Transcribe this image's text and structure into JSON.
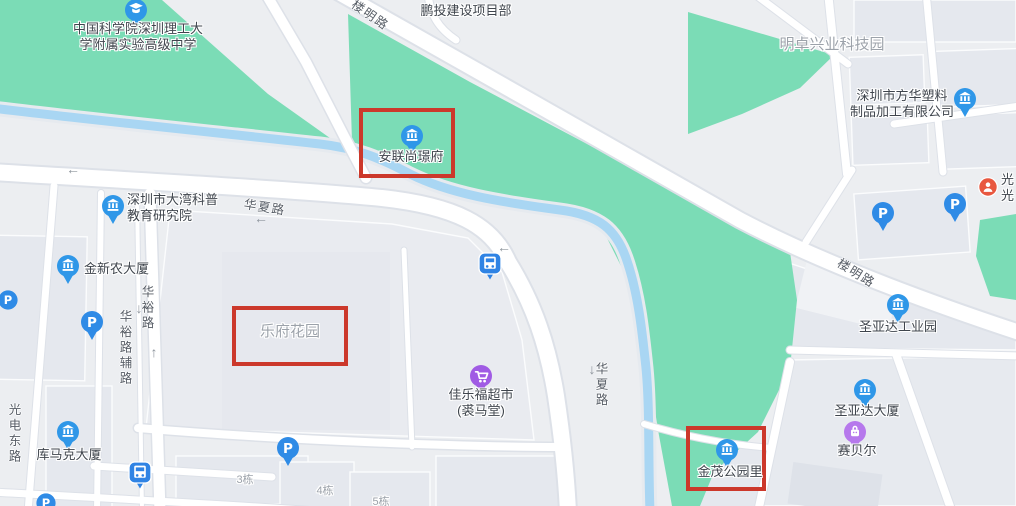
{
  "canvas": {
    "width": 1016,
    "height": 506
  },
  "colors": {
    "base_gray": "#ECEEF1",
    "block_gray": "#E5E8EE",
    "green": "#7BDCB6",
    "water_blue": "#A9D6F3",
    "road_white": "#FFFFFF",
    "highlight_red": "#CC382B",
    "pin_blue": "#2F97E8",
    "bus_blue": "#2F83E4",
    "cart_purple": "#A05BE4",
    "bag_purple": "#B678EC",
    "alert_red": "#E8573F",
    "poi_text": "#3F454D",
    "road_text": "#575D66",
    "area_text": "#9CA2AA"
  },
  "red_boxes": [
    {
      "name": "highlight-anlian-shangjingfu",
      "x": 359,
      "y": 108,
      "w": 96,
      "h": 70
    },
    {
      "name": "highlight-lefu-huayuan",
      "x": 232,
      "y": 306,
      "w": 116,
      "h": 60
    },
    {
      "name": "highlight-jinmao-gongyuanli",
      "x": 686,
      "y": 426,
      "w": 80,
      "h": 65
    }
  ],
  "pois": [
    {
      "name": "school-shenzhen-ligong",
      "icon": "pin-school",
      "ix": 136,
      "iy": 10,
      "lines": [
        "中国科学院深圳理工大",
        "学附属实验高级中学"
      ],
      "lx": 138,
      "ly": 37,
      "align": "center"
    },
    {
      "name": "pengtou-project",
      "icon": "none",
      "lines": [
        "鹏投建设项目部"
      ],
      "lx": 466,
      "ly": 11,
      "align": "center"
    },
    {
      "name": "fanghua-plastics",
      "icon": "pin-building",
      "ix": 965,
      "iy": 99,
      "lines": [
        "深圳市方华塑料",
        "制品加工有限公司"
      ],
      "lx": 902,
      "ly": 104,
      "align": "center"
    },
    {
      "name": "anlian-shangjingfu",
      "icon": "pin-building",
      "ix": 412,
      "iy": 136,
      "lines": [
        "安联尚璟府"
      ],
      "lx": 411,
      "ly": 157,
      "align": "center"
    },
    {
      "name": "dawan-kepu-institute",
      "icon": "pin-building",
      "ix": 113,
      "iy": 206,
      "lines": [
        "深圳市大湾科普",
        "教育研究院"
      ],
      "lx": 127,
      "ly": 208,
      "align": "left"
    },
    {
      "name": "jinxinnong-tower",
      "icon": "pin-building",
      "ix": 68,
      "iy": 266,
      "lines": [
        "金新农大厦"
      ],
      "lx": 84,
      "ly": 269,
      "align": "left"
    },
    {
      "name": "jialefu-supermarket",
      "icon": "pin-cart",
      "ix": 481,
      "iy": 376,
      "lines": [
        "佳乐福超市",
        "(裘马堂)"
      ],
      "lx": 481,
      "ly": 403,
      "align": "center"
    },
    {
      "name": "shengyada-industrial-park",
      "icon": "pin-building",
      "ix": 898,
      "iy": 305,
      "lines": [
        "圣亚达工业园"
      ],
      "lx": 898,
      "ly": 327,
      "align": "center"
    },
    {
      "name": "shengyada-tower",
      "icon": "pin-building",
      "ix": 865,
      "iy": 390,
      "lines": [
        "圣亚达大厦"
      ],
      "lx": 867,
      "ly": 411,
      "align": "center"
    },
    {
      "name": "saibeier",
      "icon": "pin-bag",
      "ix": 855,
      "iy": 432,
      "lines": [
        "赛贝尔"
      ],
      "lx": 857,
      "ly": 451,
      "align": "center"
    },
    {
      "name": "jinmao-gongyuanli",
      "icon": "pin-building",
      "ix": 727,
      "iy": 450,
      "lines": [
        "金茂公园里"
      ],
      "lx": 730,
      "ly": 472,
      "align": "center"
    },
    {
      "name": "kumake-tower",
      "icon": "pin-building",
      "ix": 68,
      "iy": 432,
      "lines": [
        "库马克大厦"
      ],
      "lx": 69,
      "ly": 455,
      "align": "center"
    },
    {
      "name": "guang-clipped",
      "icon": "circle-alert",
      "ix": 988,
      "iy": 187,
      "lines": [
        "光",
        "光"
      ],
      "lx": 1001,
      "ly": 188,
      "align": "left"
    },
    {
      "name": "parking-huayu",
      "icon": "pin-p",
      "ix": 92,
      "iy": 322
    },
    {
      "name": "parking-grid-west",
      "icon": "pin-p",
      "ix": 883,
      "iy": 213
    },
    {
      "name": "parking-grid-east",
      "icon": "pin-p",
      "ix": 955,
      "iy": 204
    },
    {
      "name": "parking-left-edge",
      "icon": "circle-p",
      "ix": 8,
      "iy": 300
    },
    {
      "name": "parking-lefu-south",
      "icon": "pin-p",
      "ix": 288,
      "iy": 448
    },
    {
      "name": "parking-bottom-left",
      "icon": "circle-p",
      "ix": 46,
      "iy": 503
    },
    {
      "name": "bus-stop-huaxia",
      "icon": "bus",
      "ix": 490,
      "iy": 263
    },
    {
      "name": "bus-stop-south",
      "icon": "bus",
      "ix": 140,
      "iy": 472
    }
  ],
  "area_labels": [
    {
      "name": "mingzhuo-tech-park",
      "text": "明卓兴业科技园",
      "x": 832,
      "y": 45,
      "size": 15
    },
    {
      "name": "lefu-huayuan",
      "text": "乐府花园",
      "x": 290,
      "y": 332,
      "size": 15
    },
    {
      "name": "building-3",
      "text": "3栋",
      "x": 245,
      "y": 480,
      "size": 11
    },
    {
      "name": "building-4",
      "text": "4栋",
      "x": 325,
      "y": 491,
      "size": 11
    },
    {
      "name": "building-5",
      "text": "5栋",
      "x": 381,
      "y": 502,
      "size": 11
    }
  ],
  "road_labels": [
    {
      "name": "louming-road-nw",
      "text": "楼明路",
      "x": 371,
      "y": 14,
      "rot": 35
    },
    {
      "name": "louming-road-se",
      "text": "楼明路",
      "x": 857,
      "y": 272,
      "rot": 32
    },
    {
      "name": "huaxia-road-h",
      "text": "华夏路",
      "x": 265,
      "y": 206,
      "rot": 9
    },
    {
      "name": "huaxia-road-v",
      "text": "华夏路",
      "x": 601,
      "y": 385,
      "vertical": true
    },
    {
      "name": "huayu-road",
      "text": "华裕路",
      "x": 147,
      "y": 308,
      "vertical": true
    },
    {
      "name": "huayu-frontage-road",
      "text": "华裕路辅路",
      "x": 125,
      "y": 348,
      "vertical": true
    },
    {
      "name": "guangdian-east-road",
      "text": "光电东路",
      "x": 14,
      "y": 434,
      "vertical": true
    }
  ],
  "arrows": [
    {
      "name": "arrow-left-huaxia-w",
      "glyph": "←",
      "x": 73,
      "y": 169
    },
    {
      "name": "arrow-left-huaxia-label",
      "glyph": "←",
      "x": 261,
      "y": 218
    },
    {
      "name": "arrow-left-huaxia-corner",
      "glyph": "←",
      "x": 504,
      "y": 247
    },
    {
      "name": "arrow-up-huayu",
      "glyph": "↑",
      "x": 154,
      "y": 352
    },
    {
      "name": "arrow-down-huayu-label",
      "glyph": "↓",
      "x": 139,
      "y": 308
    },
    {
      "name": "arrow-down-huaxia-v",
      "glyph": "↓",
      "x": 592,
      "y": 369
    }
  ]
}
